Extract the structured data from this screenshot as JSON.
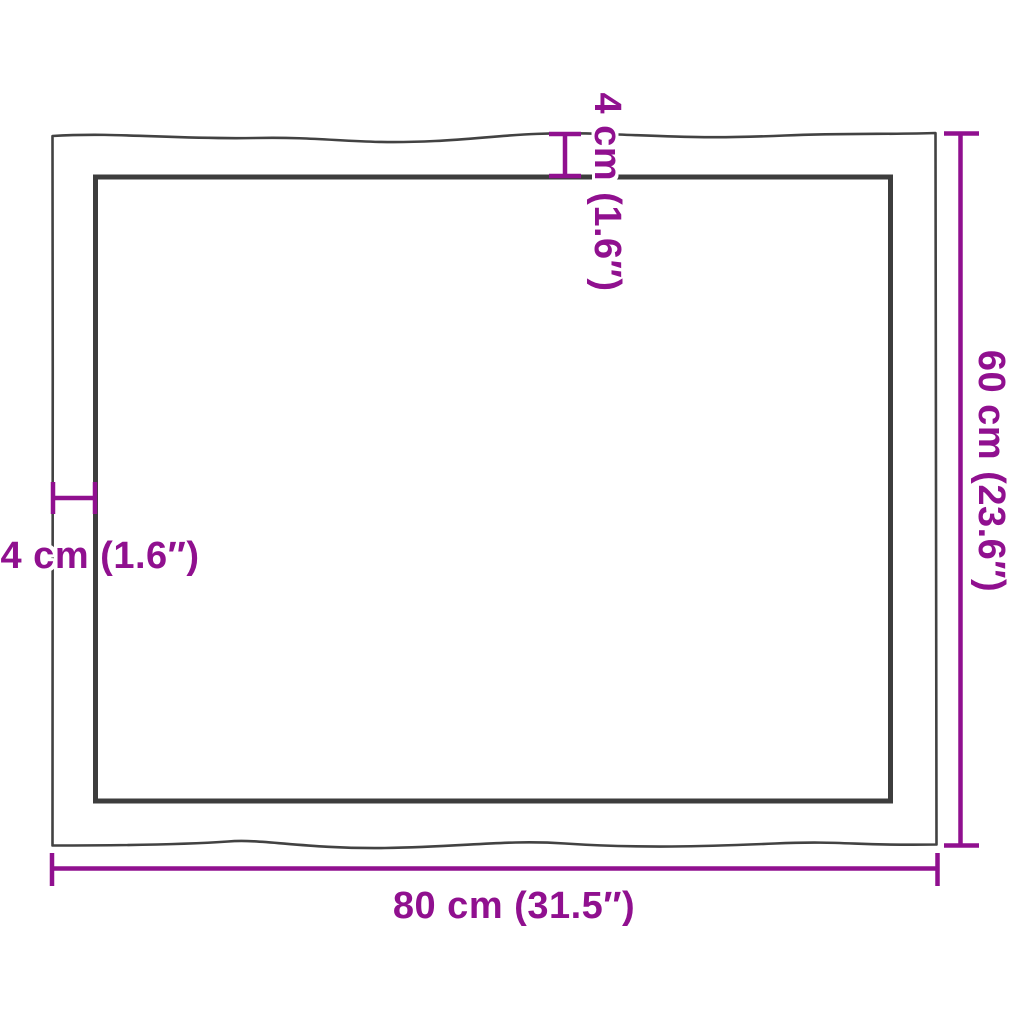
{
  "colors": {
    "dimension_magenta": "#90108f",
    "edge_outline_dark": "#3f3f3f",
    "background": "#ffffff"
  },
  "dimensions": {
    "width_label": "80 cm (31.5″)",
    "height_label": "60 cm (23.6″)",
    "thickness_top_label": "4 cm (1.6″)",
    "thickness_left_label": "4 cm (1.6″)"
  }
}
